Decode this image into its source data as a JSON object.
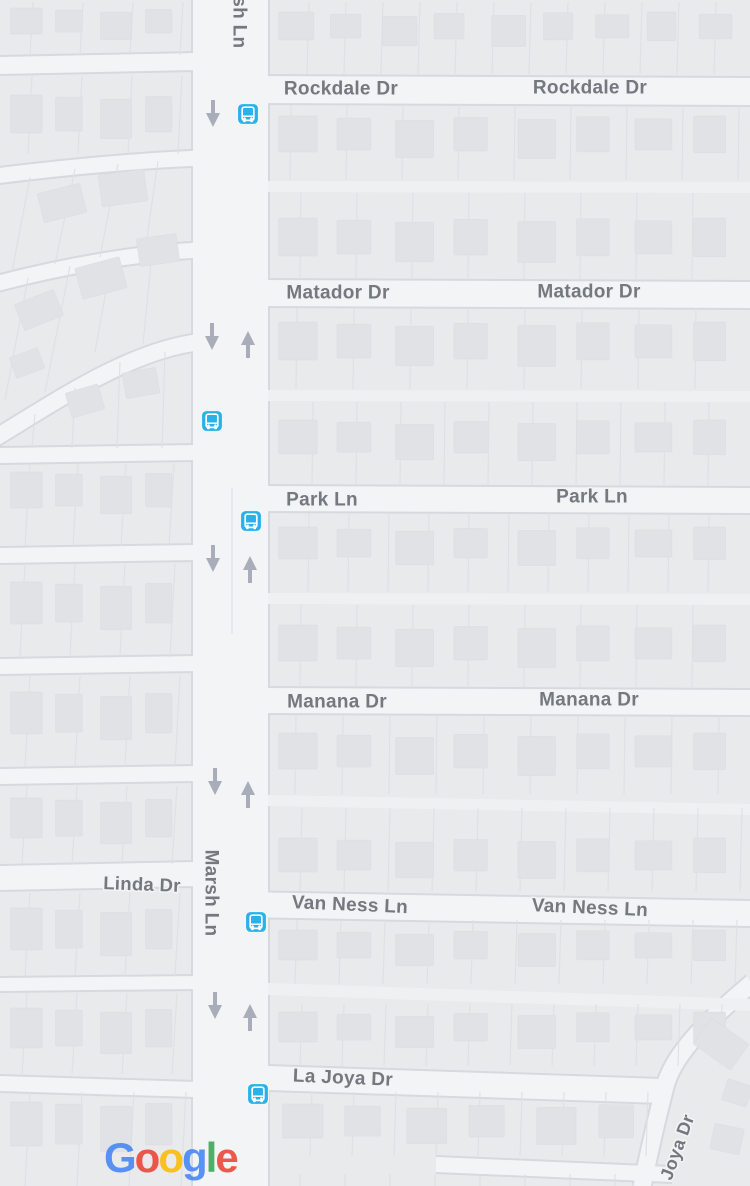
{
  "map": {
    "attribution_logo": "Google",
    "colors": {
      "block": "#e9eaec",
      "road": "#f3f4f6",
      "alley": "#eef0f2",
      "casing": "#d7d9dd",
      "lot_line": "#dfe0e3",
      "building": "#e1e2e5",
      "building_edge": "#d8dade",
      "label_text": "#74787f",
      "label_halo": "#f2f3f5",
      "oneway_arrow": "#a8adb9",
      "bus_icon_blue": "#29b1e8",
      "bus_icon_glyph": "#ffffff"
    },
    "street_labels": [
      {
        "text": "Rockdale Dr",
        "x": 341,
        "y": 88,
        "rot": 0,
        "size": 19
      },
      {
        "text": "Rockdale Dr",
        "x": 590,
        "y": 87,
        "rot": 0,
        "size": 19
      },
      {
        "text": "Matador Dr",
        "x": 338,
        "y": 292,
        "rot": 0,
        "size": 19
      },
      {
        "text": "Matador Dr",
        "x": 589,
        "y": 291,
        "rot": 0,
        "size": 19
      },
      {
        "text": "Park Ln",
        "x": 322,
        "y": 499,
        "rot": 0,
        "size": 19
      },
      {
        "text": "Park Ln",
        "x": 592,
        "y": 496,
        "rot": 0,
        "size": 19
      },
      {
        "text": "Manana Dr",
        "x": 337,
        "y": 701,
        "rot": 0,
        "size": 19
      },
      {
        "text": "Manana Dr",
        "x": 589,
        "y": 699,
        "rot": 0,
        "size": 19
      },
      {
        "text": "Van Ness Ln",
        "x": 350,
        "y": 904,
        "rot": 2.5,
        "size": 19
      },
      {
        "text": "Van Ness Ln",
        "x": 590,
        "y": 907,
        "rot": 2.5,
        "size": 19
      },
      {
        "text": "Linda Dr",
        "x": 142,
        "y": 884,
        "rot": 2,
        "size": 18.5
      },
      {
        "text": "La Joya Dr",
        "x": 343,
        "y": 1077,
        "rot": 2.5,
        "size": 19
      },
      {
        "text": "Marsh Ln",
        "x": 240,
        "y": 5,
        "rot": 90,
        "size": 19
      },
      {
        "text": "Marsh Ln",
        "x": 212,
        "y": 893,
        "rot": 90,
        "size": 19
      },
      {
        "text": "Joya Dr",
        "x": 677,
        "y": 1147,
        "rot": -70,
        "size": 18
      }
    ],
    "bus_stops": [
      {
        "x": 248,
        "y": 114
      },
      {
        "x": 212,
        "y": 421
      },
      {
        "x": 251,
        "y": 521
      },
      {
        "x": 256,
        "y": 922
      },
      {
        "x": 258,
        "y": 1094
      }
    ],
    "oneway_arrows": [
      {
        "x": 213,
        "y": 100,
        "dir": "down"
      },
      {
        "x": 212,
        "y": 323,
        "dir": "down"
      },
      {
        "x": 213,
        "y": 545,
        "dir": "down"
      },
      {
        "x": 215,
        "y": 768,
        "dir": "down"
      },
      {
        "x": 215,
        "y": 992,
        "dir": "down"
      },
      {
        "x": 248,
        "y": 331,
        "dir": "up"
      },
      {
        "x": 250,
        "y": 556,
        "dir": "up"
      },
      {
        "x": 248,
        "y": 781,
        "dir": "up"
      },
      {
        "x": 250,
        "y": 1004,
        "dir": "up"
      }
    ],
    "roads": {
      "marsh_vertical": {
        "x": 193,
        "w": 75
      },
      "h_right": [
        {
          "x1": 240,
          "x2": 752,
          "y": 76,
          "h": 27,
          "tilt": 2
        },
        {
          "x1": 240,
          "x2": 752,
          "y": 280,
          "h": 26,
          "tilt": 2
        },
        {
          "x1": 240,
          "x2": 752,
          "y": 486,
          "h": 25,
          "tilt": 2
        },
        {
          "x1": 240,
          "x2": 752,
          "y": 688,
          "h": 25,
          "tilt": 2
        },
        {
          "x1": 240,
          "x2": 752,
          "y": 892,
          "h": 25,
          "tilt": 9
        },
        {
          "x1": 240,
          "x2": 662,
          "y": 1065,
          "h": 24,
          "tilt": 14
        },
        {
          "x1": 436,
          "x2": 672,
          "y": 1157,
          "h": 15,
          "tilt": 10
        }
      ],
      "h_left": [
        {
          "x1": -2,
          "x2": 196,
          "y": 57,
          "h": 17,
          "tilt": -4
        },
        {
          "x1": -2,
          "x2": 196,
          "y": 448,
          "h": 15,
          "tilt": -3
        },
        {
          "x1": -2,
          "x2": 196,
          "y": 548,
          "h": 15,
          "tilt": -3
        },
        {
          "x1": -2,
          "x2": 196,
          "y": 659,
          "h": 15,
          "tilt": -3
        },
        {
          "x1": -2,
          "x2": 196,
          "y": 769,
          "h": 15,
          "tilt": -3
        },
        {
          "x1": -2,
          "x2": 196,
          "y": 866,
          "h": 24,
          "tilt": -4
        },
        {
          "x1": -2,
          "x2": 196,
          "y": 978,
          "h": 13,
          "tilt": -2
        },
        {
          "x1": -2,
          "x2": 196,
          "y": 1076,
          "h": 15,
          "tilt": 6
        }
      ],
      "arcs": [
        {
          "d": "M -5 176 C 60 168 130 161 200 158",
          "w": 15
        },
        {
          "d": "M -5 284 C 60 267 135 253 200 250",
          "w": 15
        },
        {
          "d": "M -5 438 C 55 402 130 350 200 342",
          "w": 16
        },
        {
          "d": "M 752 983 C 706 1022 676 1052 666 1083 C 657 1117 649 1152 642 1187",
          "w": 17
        }
      ],
      "alleys": [
        {
          "x1": 268,
          "x2": 752,
          "y": 181,
          "h": 11,
          "tilt": 1
        },
        {
          "x1": 268,
          "x2": 752,
          "y": 390,
          "h": 11,
          "tilt": 1
        },
        {
          "x1": 268,
          "x2": 752,
          "y": 593,
          "h": 11,
          "tilt": 1
        },
        {
          "x1": 268,
          "x2": 752,
          "y": 795,
          "h": 11,
          "tilt": 9
        },
        {
          "x1": 268,
          "x2": 752,
          "y": 983,
          "h": 12,
          "tilt": 16
        }
      ],
      "centerline": {
        "x": 232,
        "y1": 488,
        "y2": 634
      }
    },
    "lot_rows": [
      {
        "x1": 270,
        "x2": 748,
        "y1": 2,
        "y2": 74,
        "off": 307,
        "sp": 37,
        "dx": 2
      },
      {
        "x1": 270,
        "x2": 748,
        "y1": 105,
        "y2": 180,
        "off": 290,
        "sp": 56,
        "dx": 1
      },
      {
        "x1": 270,
        "x2": 748,
        "y1": 193,
        "y2": 279,
        "off": 300,
        "sp": 56,
        "dx": 1
      },
      {
        "x1": 270,
        "x2": 748,
        "y1": 308,
        "y2": 389,
        "off": 296,
        "sp": 57,
        "dx": 1
      },
      {
        "x1": 270,
        "x2": 748,
        "y1": 402,
        "y2": 485,
        "off": 312,
        "sp": 44,
        "dx": 1
      },
      {
        "x1": 270,
        "x2": 748,
        "y1": 513,
        "y2": 592,
        "off": 308,
        "sp": 40,
        "dx": 1
      },
      {
        "x1": 270,
        "x2": 748,
        "y1": 605,
        "y2": 687,
        "off": 300,
        "sp": 56,
        "dx": 1
      },
      {
        "x1": 270,
        "x2": 748,
        "y1": 715,
        "y2": 794,
        "off": 295,
        "sp": 47,
        "dx": 1
      },
      {
        "x1": 270,
        "x2": 748,
        "y1": 808,
        "y2": 891,
        "off": 300,
        "sp": 44,
        "dx": 2
      },
      {
        "x1": 270,
        "x2": 748,
        "y1": 920,
        "y2": 984,
        "off": 295,
        "sp": 44,
        "dx": 2
      },
      {
        "x1": 270,
        "x2": 748,
        "y1": 1004,
        "y2": 1066,
        "off": 300,
        "sp": 42,
        "dx": 2
      },
      {
        "x1": 270,
        "x2": 666,
        "y1": 1092,
        "y2": 1156,
        "off": 310,
        "sp": 42,
        "dx": 2
      },
      {
        "x1": 270,
        "x2": 640,
        "y1": 1174,
        "y2": 1186,
        "off": 300,
        "sp": 45,
        "dx": 0
      },
      {
        "x1": 0,
        "x2": 192,
        "y1": 2,
        "y2": 55,
        "off": 30,
        "sp": 50,
        "dx": 3
      },
      {
        "x1": 0,
        "x2": 192,
        "y1": 76,
        "y2": 154,
        "off": 28,
        "sp": 50,
        "dx": 4
      },
      {
        "x1": 0,
        "x2": 192,
        "y1": 464,
        "y2": 546,
        "off": 25,
        "sp": 48,
        "dx": 5
      },
      {
        "x1": 0,
        "x2": 192,
        "y1": 564,
        "y2": 657,
        "off": 20,
        "sp": 50,
        "dx": 5
      },
      {
        "x1": 0,
        "x2": 192,
        "y1": 676,
        "y2": 767,
        "off": 25,
        "sp": 50,
        "dx": 5
      },
      {
        "x1": 0,
        "x2": 192,
        "y1": 786,
        "y2": 864,
        "off": 22,
        "sp": 50,
        "dx": 5
      },
      {
        "x1": 0,
        "x2": 192,
        "y1": 893,
        "y2": 976,
        "off": 25,
        "sp": 50,
        "dx": 5
      },
      {
        "x1": 0,
        "x2": 192,
        "y1": 993,
        "y2": 1074,
        "off": 22,
        "sp": 50,
        "dx": 5
      },
      {
        "x1": 0,
        "x2": 192,
        "y1": 1092,
        "y2": 1186,
        "off": 25,
        "sp": 52,
        "dx": 5
      }
    ],
    "fan_lines": [
      [
        30,
        177,
        12,
        272
      ],
      [
        75,
        169,
        55,
        264
      ],
      [
        118,
        164,
        100,
        257
      ],
      [
        158,
        161,
        145,
        252
      ],
      [
        28,
        278,
        5,
        400
      ],
      [
        70,
        266,
        45,
        392
      ],
      [
        112,
        258,
        95,
        352
      ],
      [
        152,
        253,
        143,
        344
      ],
      [
        165,
        352,
        162,
        448
      ],
      [
        120,
        362,
        117,
        448
      ],
      [
        75,
        388,
        72,
        448
      ],
      [
        35,
        414,
        32,
        448
      ]
    ],
    "building_rows": [
      {
        "x1": 272,
        "x2": 748,
        "y": 12,
        "h": 32,
        "n": 9
      },
      {
        "x1": 272,
        "x2": 748,
        "y": 116,
        "h": 40,
        "n": 8
      },
      {
        "x1": 272,
        "x2": 748,
        "y": 218,
        "h": 42,
        "n": 8
      },
      {
        "x1": 272,
        "x2": 748,
        "y": 322,
        "h": 42,
        "n": 8
      },
      {
        "x1": 272,
        "x2": 748,
        "y": 420,
        "h": 38,
        "n": 8
      },
      {
        "x1": 272,
        "x2": 748,
        "y": 527,
        "h": 36,
        "n": 8
      },
      {
        "x1": 272,
        "x2": 748,
        "y": 625,
        "h": 40,
        "n": 8
      },
      {
        "x1": 272,
        "x2": 748,
        "y": 733,
        "h": 40,
        "n": 8
      },
      {
        "x1": 272,
        "x2": 748,
        "y": 838,
        "h": 38,
        "n": 8
      },
      {
        "x1": 272,
        "x2": 748,
        "y": 930,
        "h": 34,
        "n": 8
      },
      {
        "x1": 272,
        "x2": 748,
        "y": 1012,
        "h": 34,
        "n": 8
      },
      {
        "x1": 276,
        "x2": 655,
        "y": 1104,
        "h": 38,
        "n": 6
      },
      {
        "x1": 4,
        "x2": 188,
        "y": 8,
        "h": 30,
        "n": 4
      },
      {
        "x1": 4,
        "x2": 188,
        "y": 95,
        "h": 42,
        "n": 4
      },
      {
        "x1": 4,
        "x2": 188,
        "y": 472,
        "h": 40,
        "n": 4
      },
      {
        "x1": 4,
        "x2": 188,
        "y": 582,
        "h": 46,
        "n": 4
      },
      {
        "x1": 4,
        "x2": 188,
        "y": 692,
        "h": 46,
        "n": 4
      },
      {
        "x1": 4,
        "x2": 188,
        "y": 798,
        "h": 44,
        "n": 4
      },
      {
        "x1": 4,
        "x2": 188,
        "y": 908,
        "h": 46,
        "n": 4
      },
      {
        "x1": 4,
        "x2": 188,
        "y": 1008,
        "h": 44,
        "n": 4
      },
      {
        "x1": 4,
        "x2": 188,
        "y": 1102,
        "h": 48,
        "n": 4
      }
    ],
    "extra_buildings": [
      [
        40,
        188,
        44,
        30,
        -14
      ],
      [
        100,
        172,
        46,
        32,
        -8
      ],
      [
        18,
        296,
        42,
        28,
        -22
      ],
      [
        78,
        262,
        46,
        32,
        -15
      ],
      [
        138,
        236,
        40,
        28,
        -8
      ],
      [
        12,
        352,
        30,
        22,
        -20
      ],
      [
        68,
        388,
        34,
        26,
        -16
      ],
      [
        124,
        370,
        34,
        26,
        -10
      ],
      [
        698,
        1028,
        46,
        32,
        35
      ],
      [
        724,
        1082,
        26,
        22,
        18
      ],
      [
        712,
        1126,
        30,
        26,
        12
      ]
    ],
    "google_logo": {
      "x": 104,
      "y": 1137,
      "size": 42,
      "letters": [
        {
          "ch": "G",
          "color": "#4285F4"
        },
        {
          "ch": "o",
          "color": "#EA4335"
        },
        {
          "ch": "o",
          "color": "#FBBC05"
        },
        {
          "ch": "g",
          "color": "#4285F4"
        },
        {
          "ch": "l",
          "color": "#34A853"
        },
        {
          "ch": "e",
          "color": "#EA4335"
        }
      ]
    }
  }
}
